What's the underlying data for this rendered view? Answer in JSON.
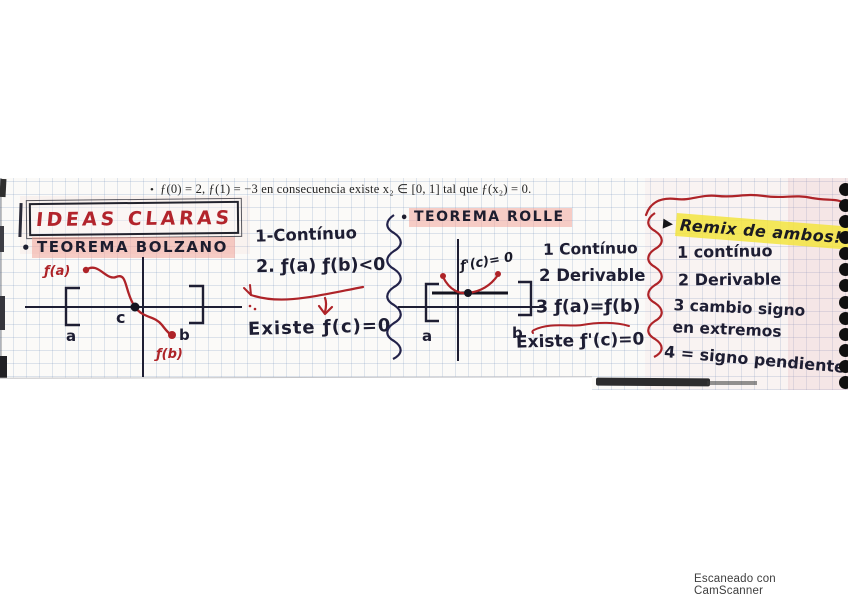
{
  "page": {
    "typed_bullet": "•",
    "typed_line": "ƒ(0) = 2, ƒ(1) = −3 en consecuencia existe x₂ ∈ [0, 1] tal que ƒ(x₂) = 0.",
    "watermark": "Escaneado con CamScanner"
  },
  "ideas": {
    "title": "IDEAS CLARAS"
  },
  "bolzano": {
    "bullet": "•",
    "title": "TEOREMA BOLZANO",
    "graph": {
      "fa": "ƒ(a)",
      "fb": "ƒ(b)",
      "a": "a",
      "b": "b",
      "c": "c"
    },
    "conditions": [
      "1-Contínuo",
      "2. ƒ(a) ƒ(b)<0"
    ],
    "conclusion": "Existe ƒ(c)=0"
  },
  "rolle": {
    "bullet": "•",
    "title": "TEOREMA ROLLE",
    "graph": {
      "fprime": "ƒ'(c)= 0",
      "a": "a",
      "b": "b"
    },
    "conditions": [
      "1 Contínuo",
      "2 Derivable",
      "3 ƒ(a)=ƒ(b)"
    ],
    "conclusion": "Existe ƒ'(c)=0"
  },
  "remix": {
    "marker": "▶",
    "title": "Remix de ambos!",
    "items": [
      "1 contínuo",
      "2 Derivable",
      "3 cambio signo\nen extremos",
      "4 = signo pendiente"
    ]
  },
  "colors": {
    "ink": "#1e1e33",
    "red_ink": "#ae2328",
    "pink_highlight": "#f3a69a",
    "yellow_highlight": "#f3e43e",
    "grid_line": "#7894be"
  }
}
